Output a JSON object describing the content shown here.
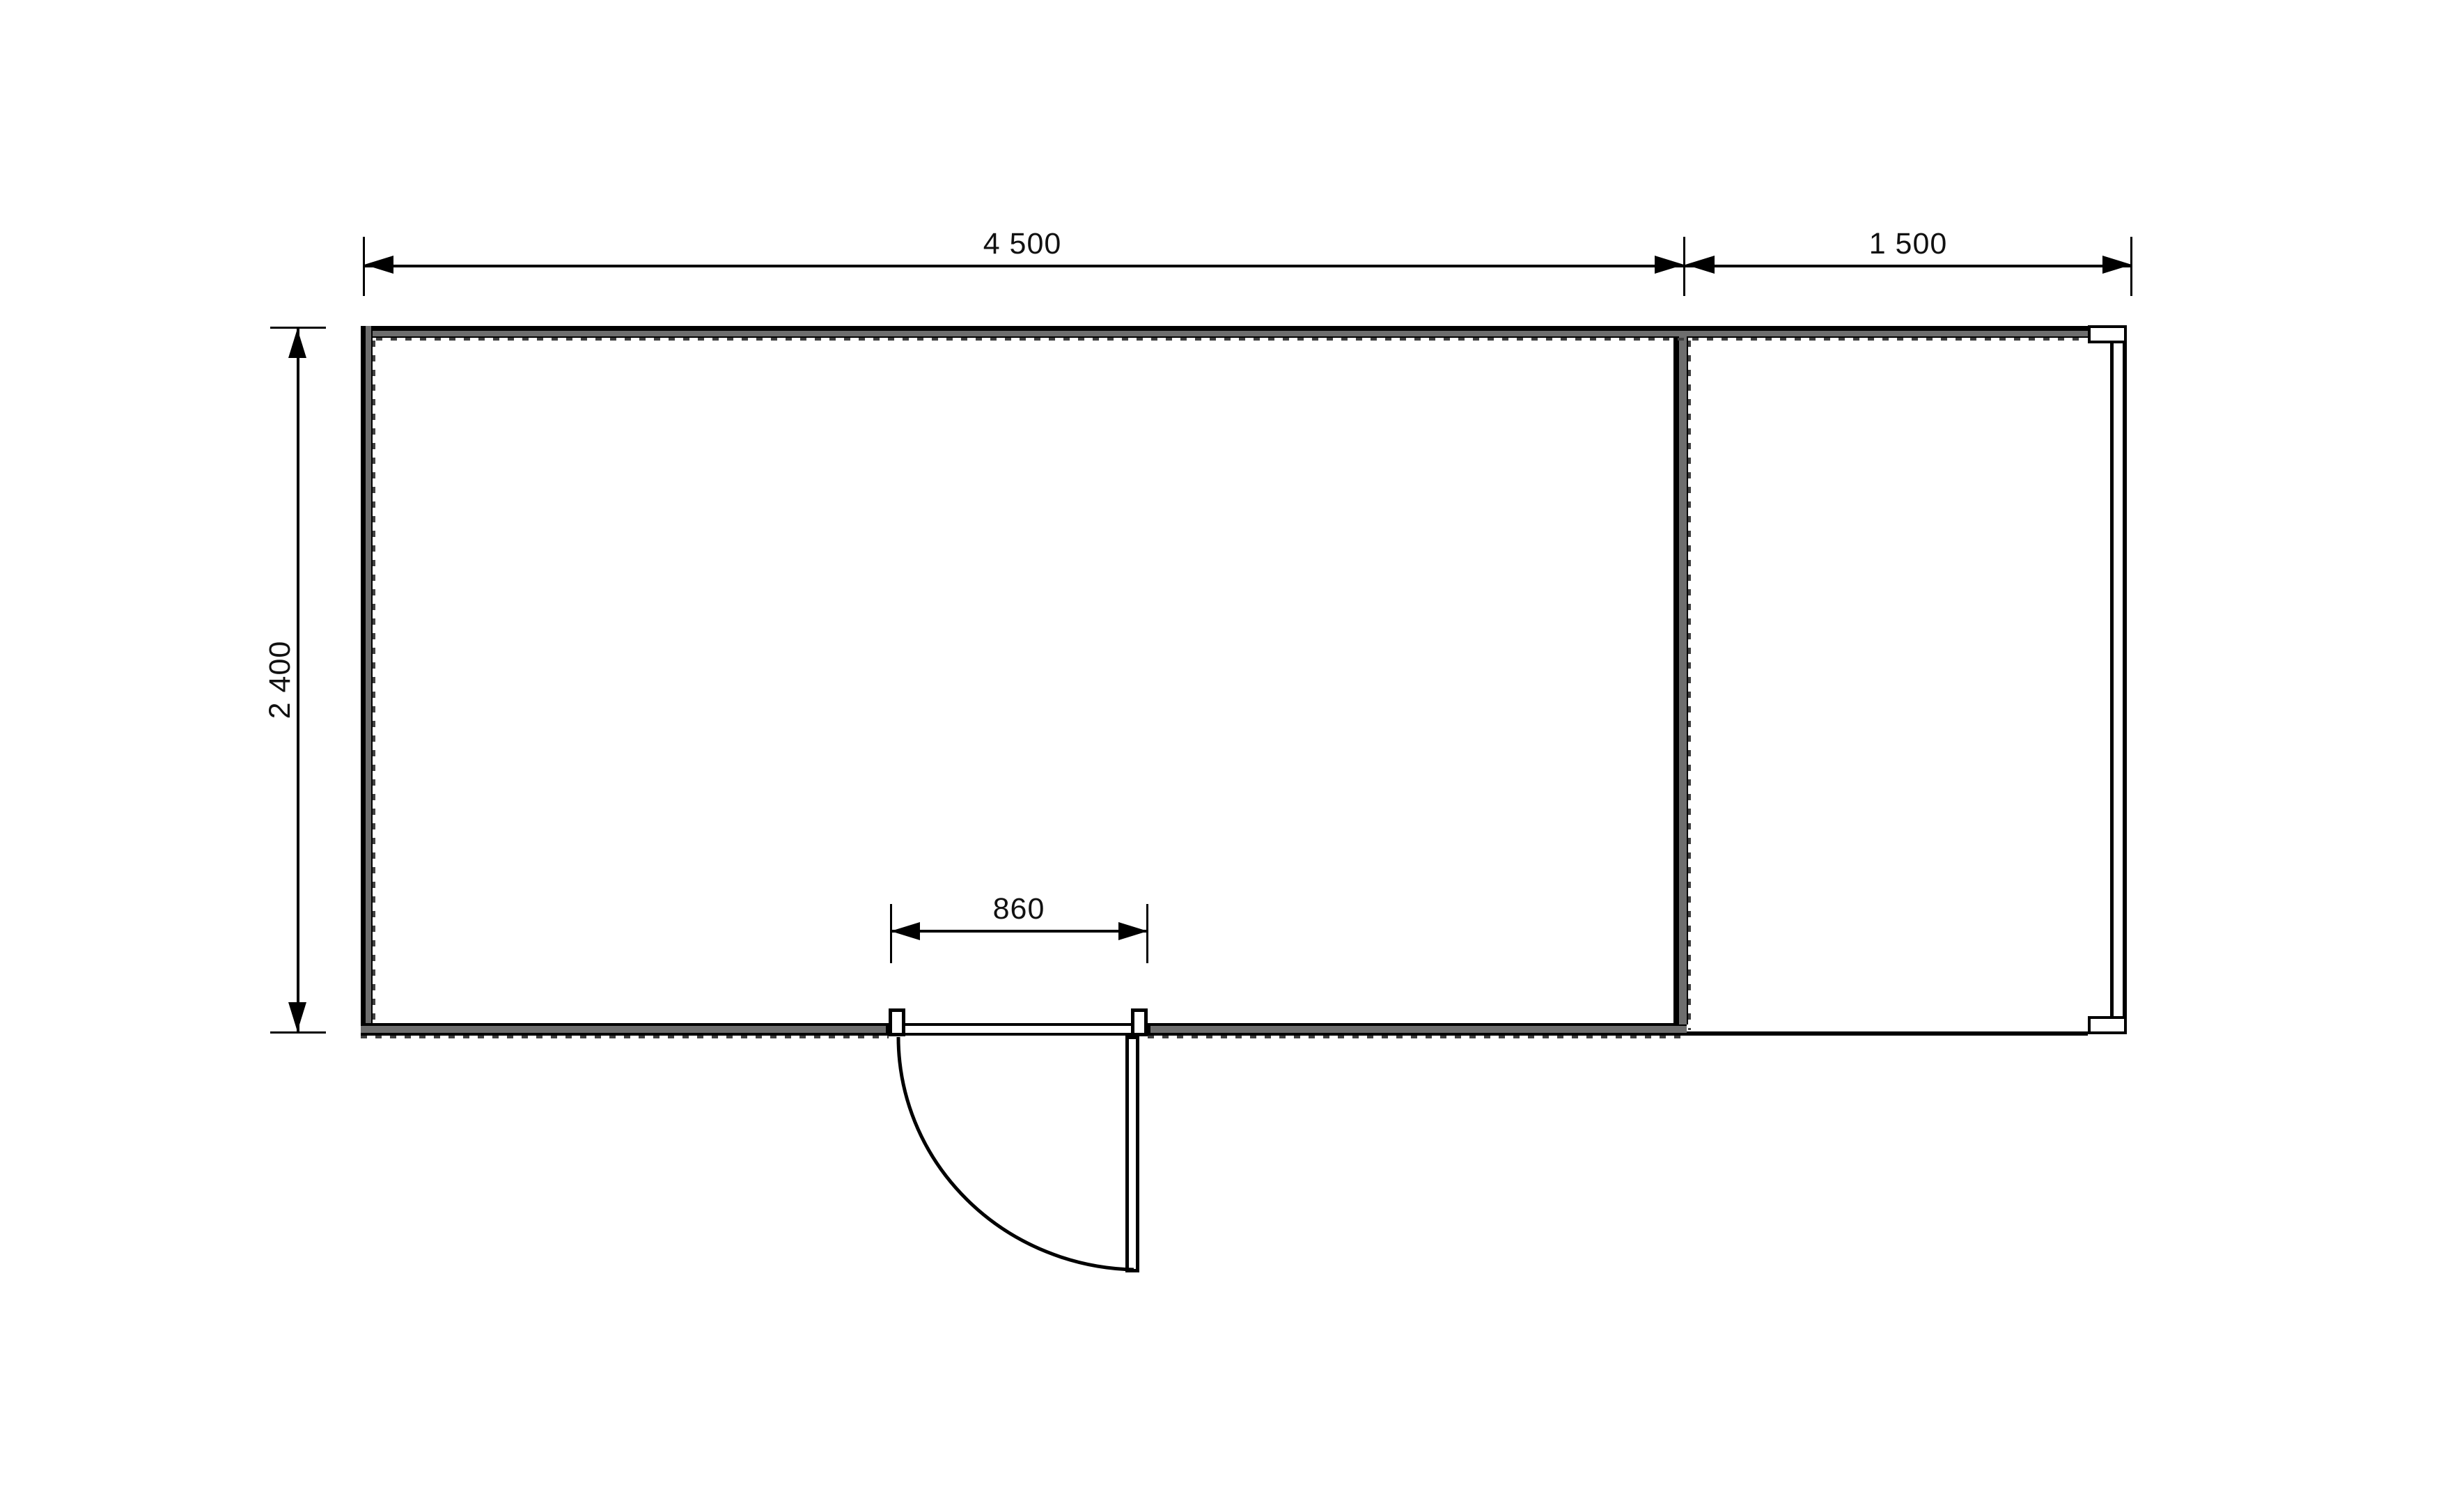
{
  "drawing": {
    "type": "floor-plan",
    "dims": {
      "main_width": "4 500",
      "terrace_width": "1 500",
      "depth": "2 400",
      "door_width": "860"
    },
    "colors": {
      "background": "#ffffff",
      "wall_fill": "#6e6e6e",
      "outline": "#000000",
      "insulation_dash": "#404040",
      "text": "#111111"
    }
  }
}
